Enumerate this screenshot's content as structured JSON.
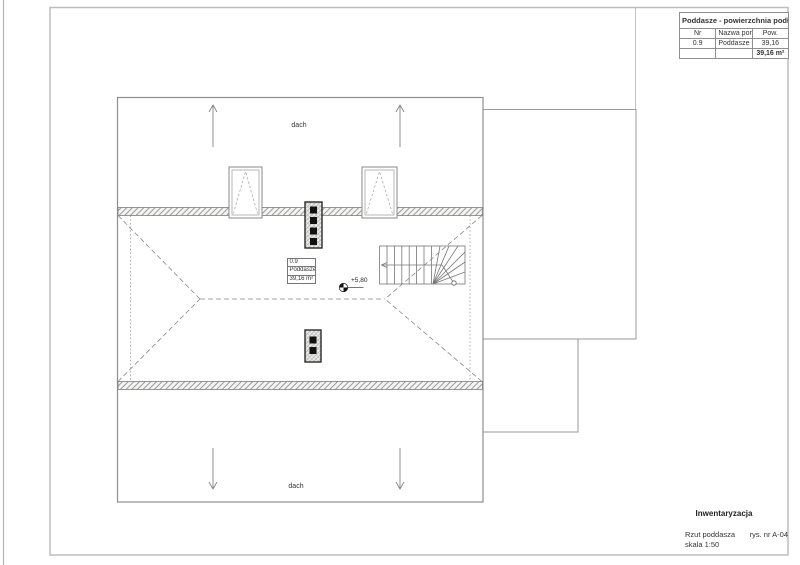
{
  "area_table": {
    "title": "Poddasze - powierzchnia podłogi",
    "columns": {
      "nr": "Nr",
      "name": "Nazwa pom.",
      "area": "Pow."
    },
    "row": {
      "nr": "0.9",
      "name": "Poddasze",
      "area": "39,16"
    },
    "total_area": "39,16 m²"
  },
  "plan": {
    "roof_labels": {
      "top": "dach",
      "bottom": "dach"
    },
    "room_tag": {
      "number": "0.9",
      "name": "Poddasze",
      "area": "39,16 m²"
    },
    "level_marker": {
      "value": "+5,80"
    }
  },
  "title_block": {
    "phase": "Inwentaryzacja",
    "drawing_title": "Rzut poddasza",
    "drawing_number": "rys. nr A-04",
    "scale": "skala 1:50"
  },
  "colors": {
    "paper": "#ffffff",
    "frame_gray": "#bdbdbd",
    "line_dark": "#2a2a2a",
    "line_mid": "#8a8a8a",
    "hatch_gray": "#9a9a9a",
    "chimney_fill": "#111111"
  }
}
